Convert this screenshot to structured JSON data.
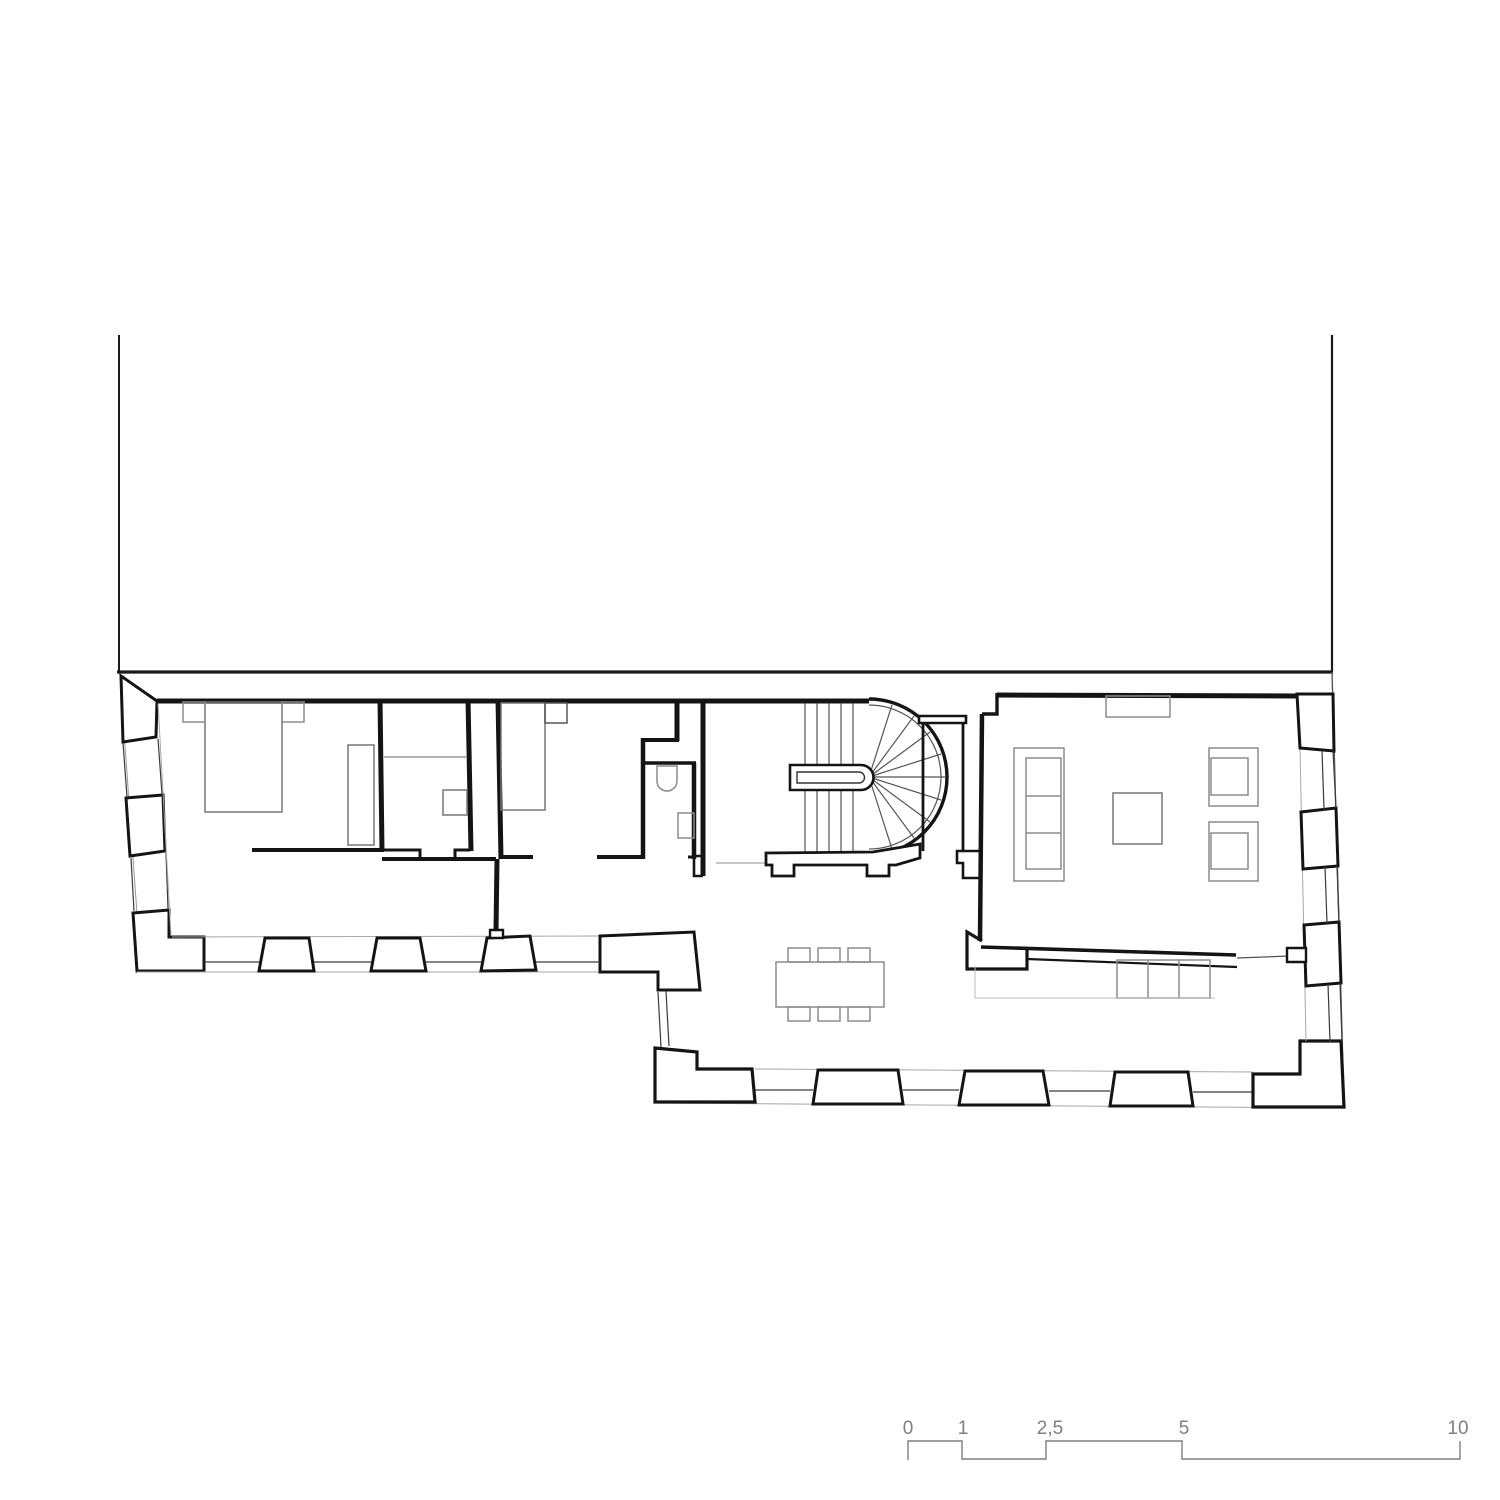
{
  "drawing": {
    "kind": "floor-plan",
    "colors": {
      "wall": "#141414",
      "thin_line": "#3a3a3a",
      "wall_face": "#a6a6a6",
      "furniture": "#8c8c8c",
      "scale_bar": "#7f7f7f",
      "background": "#ffffff"
    }
  },
  "scale_bar": {
    "labels": [
      "0",
      "1",
      "2,5",
      "5",
      "10"
    ],
    "values": [
      0,
      1,
      2.5,
      5,
      10
    ]
  }
}
